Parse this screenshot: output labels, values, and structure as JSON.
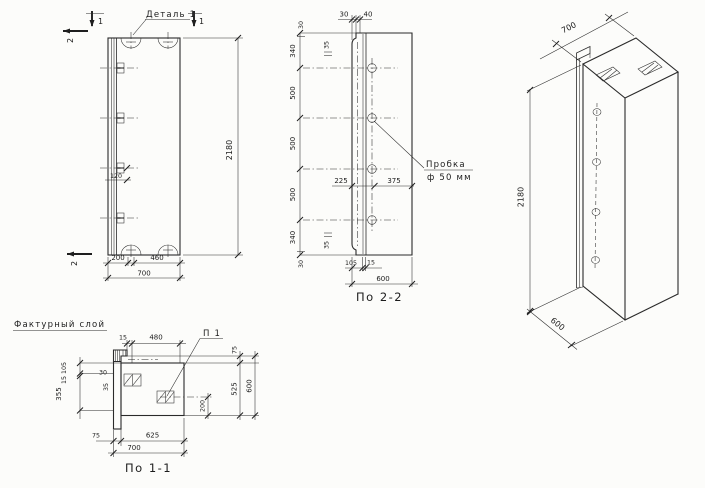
{
  "drawing": {
    "front_view": {
      "section_mark_1": "1",
      "section_mark_2": "2",
      "detail_label": "Деталь 1",
      "dims": {
        "anchor_offset": "120",
        "loop_left": "200",
        "loop_span": "460",
        "width": "700",
        "height": "2180"
      }
    },
    "section_2_2": {
      "title": "По 2-2",
      "plug_label_line1": "Пробка",
      "plug_label_line2": "ф 50 мм",
      "dims": {
        "top_a": "30",
        "top_b": "40",
        "vchain": [
          "340",
          "500",
          "500",
          "500",
          "340"
        ],
        "sub_top_a": "30",
        "sub_top_b": "35",
        "sub_bottom_a": "35",
        "sub_bottom_b": "30",
        "to_axis": "225",
        "from_axis": "375",
        "layer": "105",
        "layer_gap": "15",
        "width": "600"
      }
    },
    "iso_view": {
      "dims": {
        "width": "700",
        "height": "2180",
        "depth": "600"
      }
    },
    "section_1_1": {
      "title": "По 1-1",
      "layer_label": "Фактурный слой",
      "detail_label": "П 1",
      "dims": {
        "top_a": "15",
        "top_b": "480",
        "right_a": "75",
        "right_b": "525",
        "right_c": "600",
        "right_d": "200",
        "left_a": "105",
        "left_b": "15",
        "left_c": "355",
        "step_a": "30",
        "step_b": "35",
        "bottom_a": "75",
        "bottom_b": "625",
        "bottom_c": "700"
      }
    }
  }
}
